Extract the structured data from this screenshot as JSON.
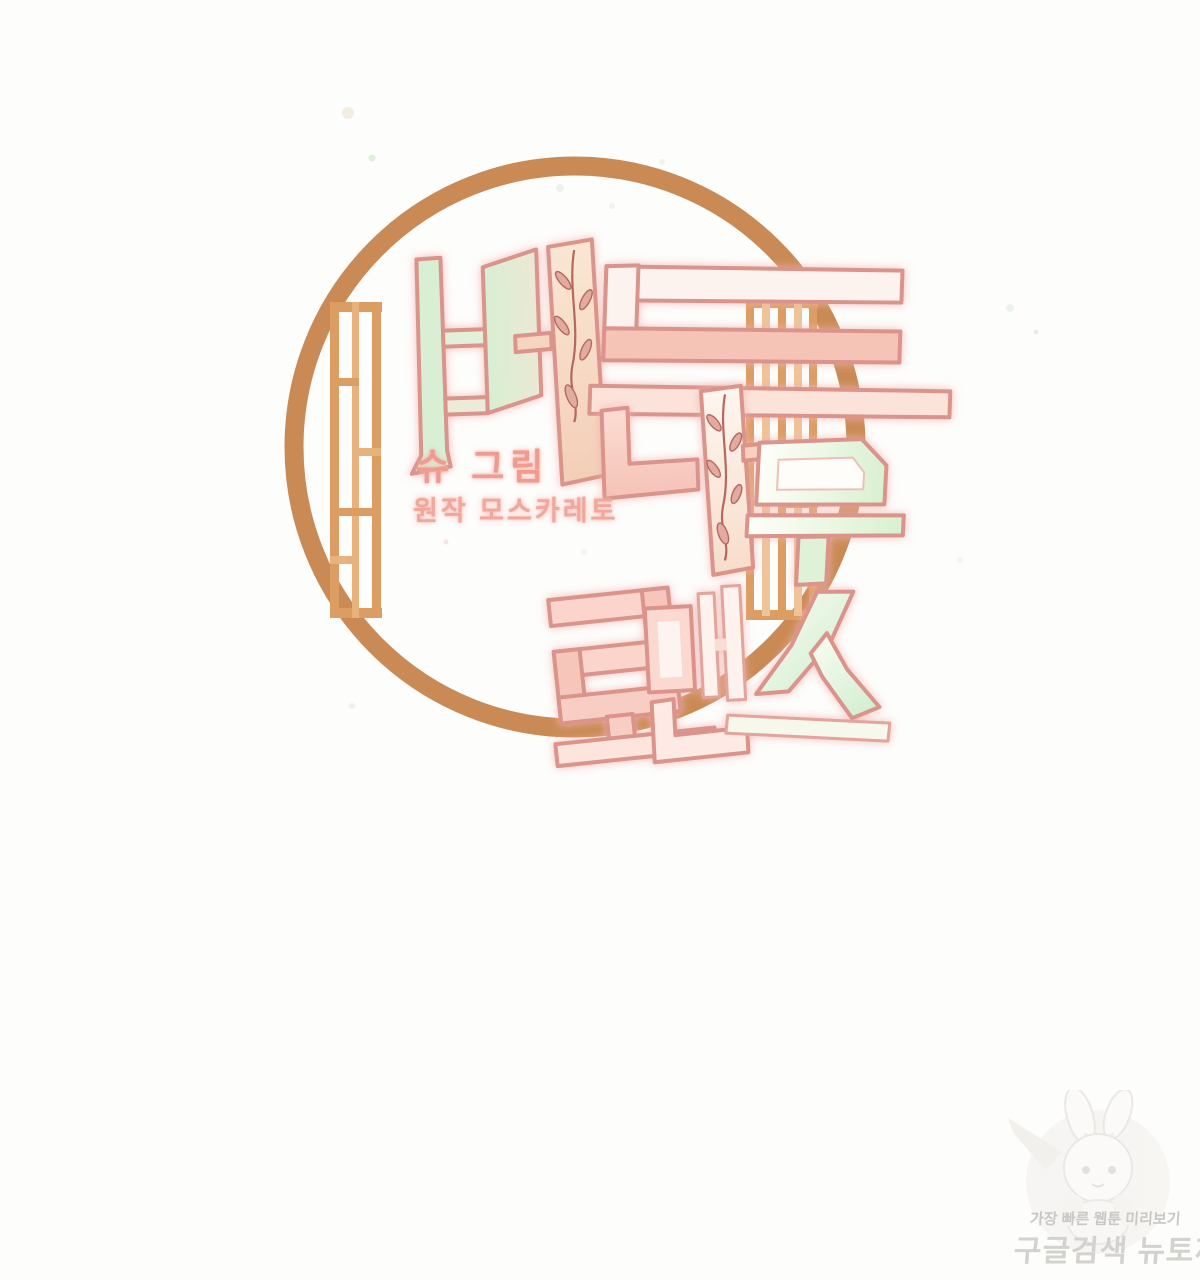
{
  "page": {
    "type": "webtoon-title-page",
    "background": "#fdfdfc"
  },
  "title": {
    "full": "버드나무 로맨스",
    "line1": "버드",
    "line2": "나무",
    "line3": "로맨스"
  },
  "credits": {
    "artist_label": "슈 그림",
    "original_label": "원작 모스카레토"
  },
  "watermark": {
    "tagline": "가장 빠른 웹툰 미리보기",
    "brand": "구글검색 뉴토끼",
    "mascot": "rabbit-girl-mascot"
  },
  "artwork": {
    "frame": "round-moon-window-frame-with-lattice",
    "decorations": [
      "willow-branch-on-beo-stem",
      "willow-branch-on-na-stem",
      "pastel-paint-speckles"
    ],
    "colors": {
      "frame_tan": "#c98a55",
      "lattice_tan": "#dc9d63",
      "lattice_light": "#eec49a",
      "outline_pink": "#db948c",
      "mint": "#d8efd4",
      "peach": "#f6d8c0",
      "pink": "#f8cdc4",
      "cream": "#efe9d7",
      "branch_rose": "#b5685f",
      "watermark_gray": "#cccac6"
    }
  }
}
